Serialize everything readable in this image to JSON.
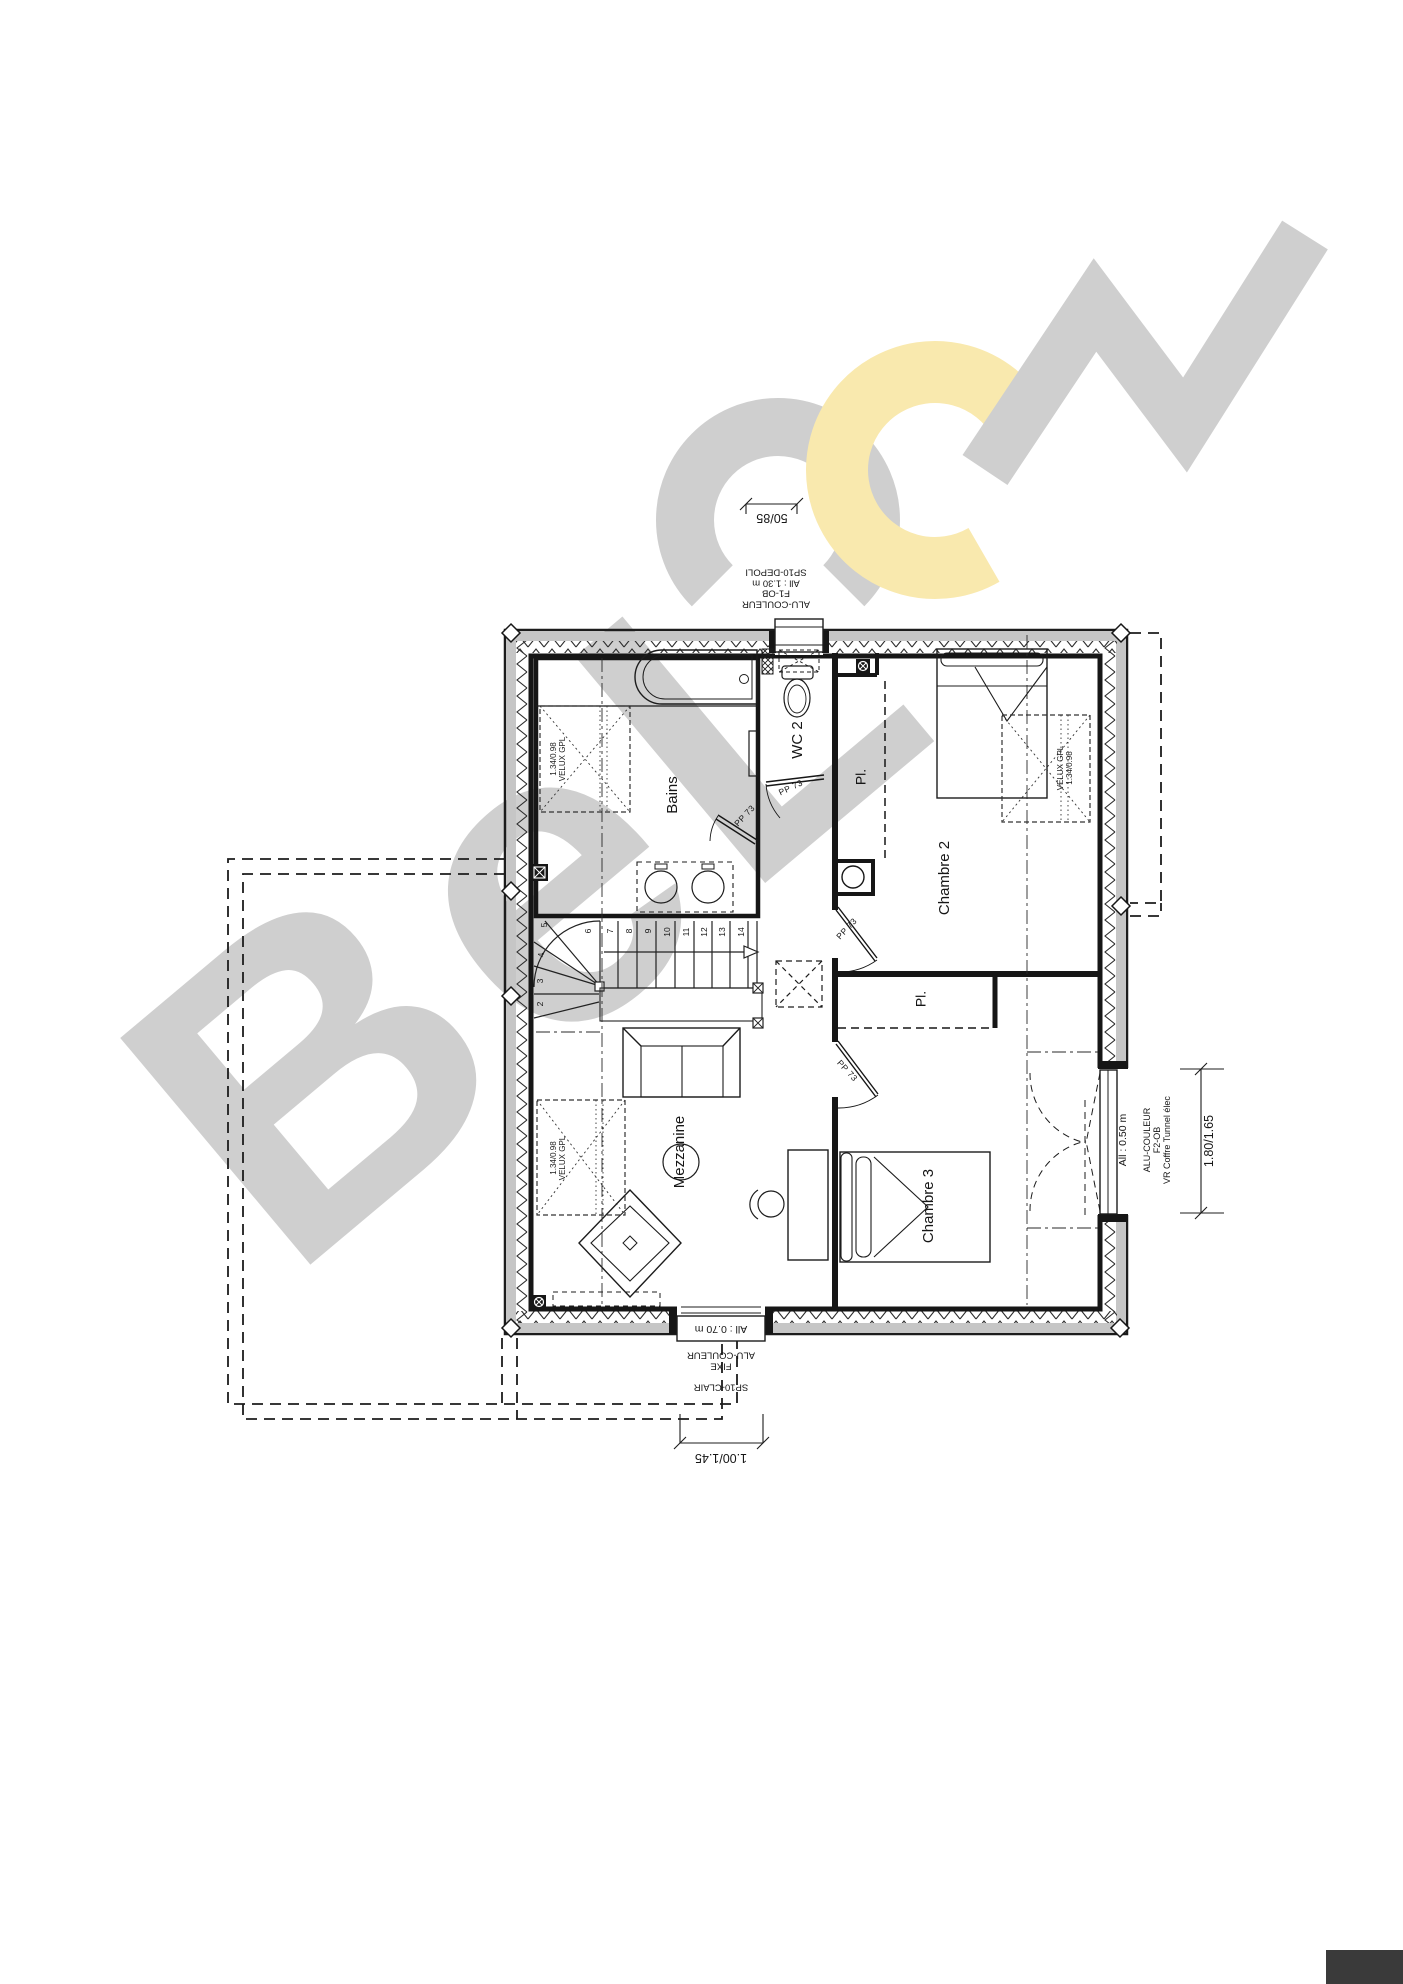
{
  "watermark": {
    "letters": "BeL",
    "gray": "#cfcfcf",
    "yellow": "#f9e9ae"
  },
  "rooms": {
    "bains": "Bains",
    "wc2": "WC 2",
    "pl_top": "Pl.",
    "chambre2": "Chambre 2",
    "pl_mid": "Pl.",
    "mezzanine": "Mezzanine",
    "chambre3": "Chambre 3"
  },
  "doors": {
    "label": "PP 73"
  },
  "stairs": {
    "numbers": [
      "2",
      "3",
      "4",
      "5",
      "6",
      "7",
      "8",
      "9",
      "10",
      "11",
      "12",
      "13",
      "14"
    ]
  },
  "skylights": {
    "label": "VELUX GPL",
    "size": "1.34/0.98"
  },
  "windows": {
    "top": {
      "dimension": "50/85",
      "annotation": [
        "ALU-COULEUR",
        "F1-OB",
        "All : 1.30 m",
        "SP10-DEPOLI"
      ]
    },
    "bottom": {
      "dimension": "1.00/1.45",
      "sill": "All : 0.70 m",
      "annotation_upper": [
        "FIXE",
        "ALU-COULEUR"
      ],
      "annotation_lower": "SP10-CLAIR"
    },
    "right": {
      "dimension": "1.80/1.65",
      "height": "All : 0.50 m",
      "annotation": [
        "ALU-COULEUR",
        "F2-OB",
        "VR Coffre Tunnel élec"
      ]
    }
  }
}
